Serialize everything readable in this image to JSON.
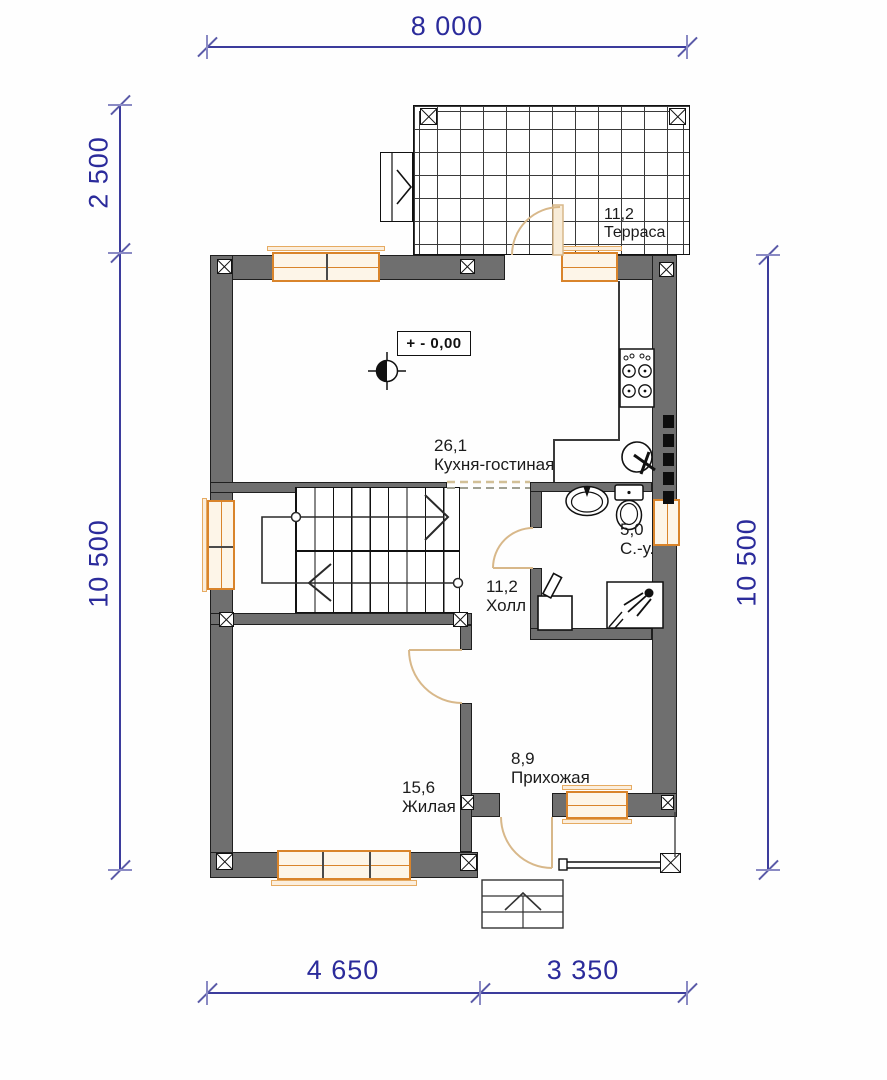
{
  "dimensions": {
    "top": "8 000",
    "bottom_left": "4 650",
    "bottom_right": "3 350",
    "left_upper": "2 500",
    "left_lower": "10 500",
    "right": "10 500"
  },
  "elevation_mark": "+ - 0,00",
  "rooms": {
    "terrace": {
      "area": "11,2",
      "name": "Терраса"
    },
    "kitchen_living": {
      "area": "26,1",
      "name": "Кухня-гостиная"
    },
    "bathroom": {
      "area": "5,0",
      "name": "С.-у."
    },
    "hall": {
      "area": "11,2",
      "name": "Холл"
    },
    "living": {
      "area": "15,6",
      "name": "Жилая"
    },
    "entry": {
      "area": "8,9",
      "name": "Прихожая"
    }
  },
  "symbols": {
    "benchmark-icon": "elevation benchmark (half-filled circle with crosshair)",
    "stove-icon": "4-burner cooktop",
    "kitchen-sink-icon": "round sink with mixer",
    "washbasin-icon": "oval washbasin",
    "toilet-icon": "toilet with cistern",
    "washing-machine-icon": "washing machine",
    "shower-icon": "shower head",
    "stairs-icon": "U-shaped staircase with walk line",
    "entrance-steps-icon": "porch steps with up arrow"
  },
  "colors": {
    "wall": "#6f6f6f",
    "window_frame": "#d9842b",
    "window_fill": "#fdf5e8",
    "door_arc": "#d8b88a",
    "dimension": "#2b2b9b",
    "label": "#1b1b1b"
  }
}
